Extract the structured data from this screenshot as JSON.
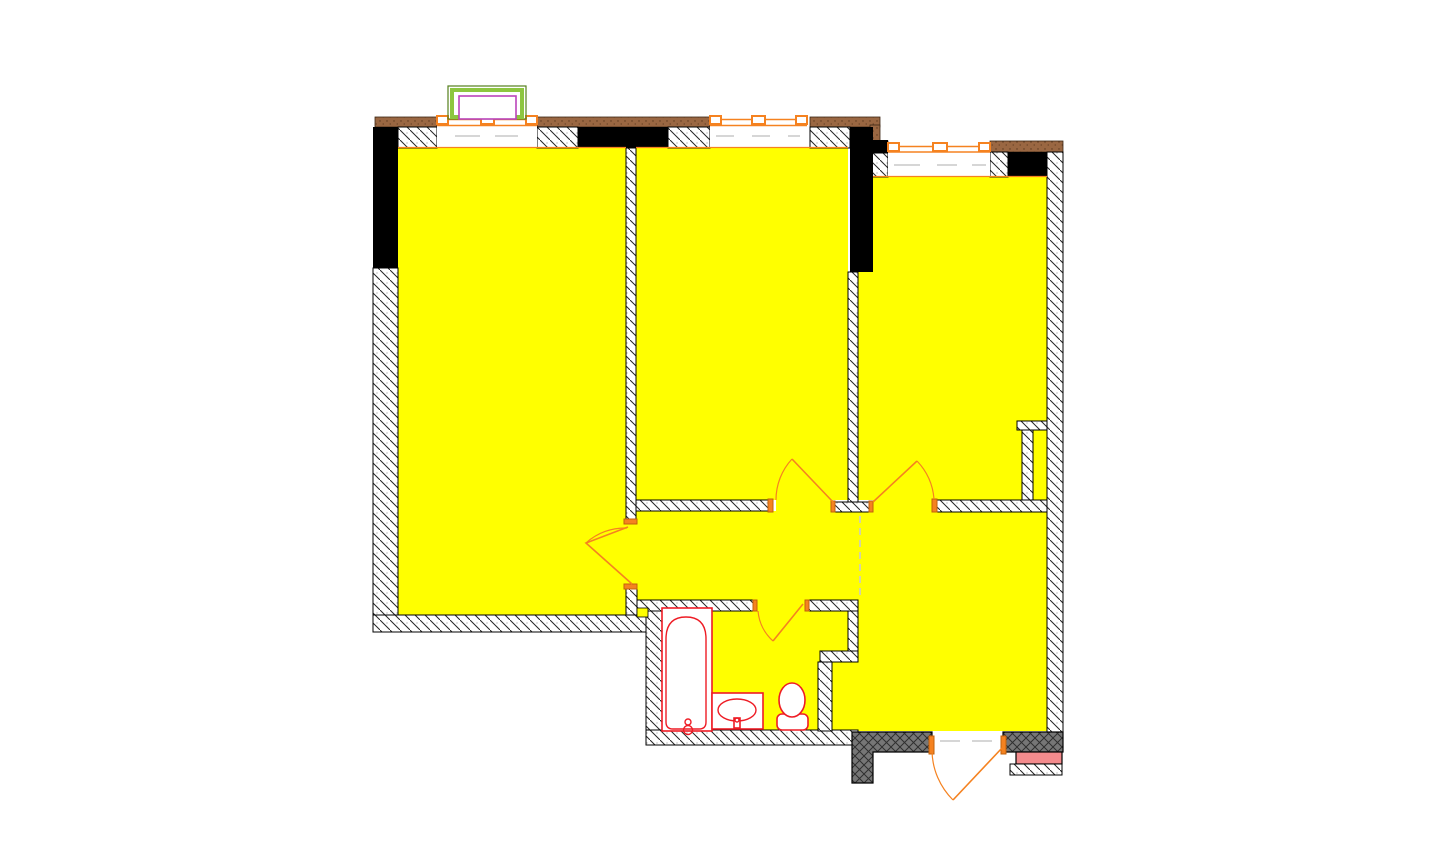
{
  "canvas": {
    "width": 1445,
    "height": 850,
    "background": "#ffffff"
  },
  "colors": {
    "background": "#ffffff",
    "floor_yellow": "#ffff00",
    "wall_line": "#000000",
    "hatch_line": "#262626",
    "hatch_dot": "#9a9a9a",
    "door_orange": "#f58220",
    "cap_orange_border": "#c2610b",
    "fixture_red": "#ee1c25",
    "facade_brown": "#9a6742",
    "facade_brown_dot": "#5a371d",
    "facade_brown_border": "#3d2714",
    "stair_gray": "#767676",
    "stair_gray_line": "#2f2f2f",
    "porch_pink": "#f48b8d",
    "balcony_lime": "#8dc63f",
    "balcony_lime_dark": "#55801c",
    "balcony_magenta": "#bb44bb",
    "dash_gray": "#c9c9c9",
    "window_white": "#ffffff"
  },
  "plan": {
    "drawing": "apartment floor plan",
    "rooms": [
      {
        "id": "room-left"
      },
      {
        "id": "room-middle"
      },
      {
        "id": "room-right"
      },
      {
        "id": "corridor"
      },
      {
        "id": "entry-hall"
      },
      {
        "id": "bathroom"
      }
    ],
    "windows": [
      {
        "id": "window-left"
      },
      {
        "id": "window-middle"
      },
      {
        "id": "window-right"
      }
    ],
    "doors": [
      {
        "id": "door-room-left"
      },
      {
        "id": "door-room-middle"
      },
      {
        "id": "door-room-right"
      },
      {
        "id": "door-bathroom"
      },
      {
        "id": "door-entry"
      }
    ],
    "fixtures": [
      {
        "id": "bathtub"
      },
      {
        "id": "washbasin"
      },
      {
        "id": "toilet"
      }
    ],
    "markers": [
      {
        "id": "balcony-frame-marker"
      },
      {
        "id": "stair-landing-block"
      },
      {
        "id": "porch-step"
      }
    ]
  }
}
